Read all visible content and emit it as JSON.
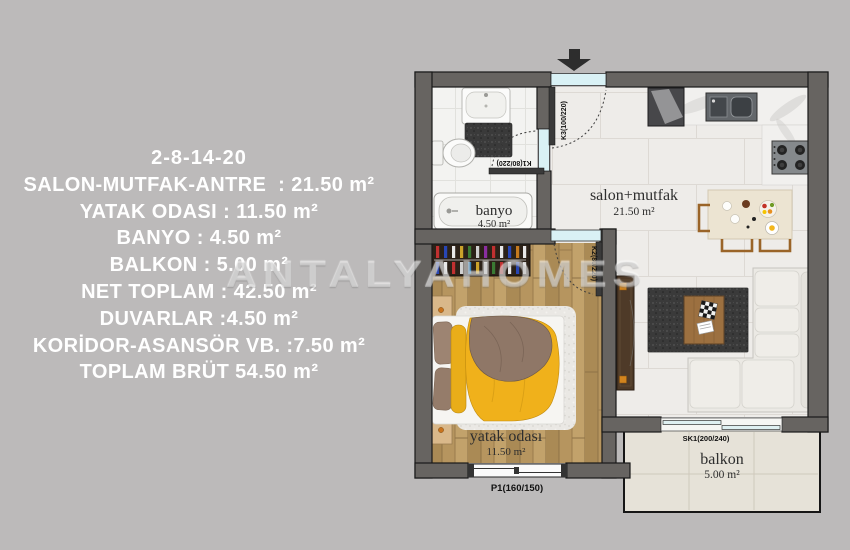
{
  "colors": {
    "background": "#bcbaba",
    "panel_text": "#ffffff",
    "wall": "#676461",
    "glass": "#d9f1f5",
    "duvet_yellow": "#f0b11b",
    "wood_floor": "#b3925e",
    "balcony_floor": "#e6e2d8"
  },
  "info_panel": {
    "unit_numbers": "2-8-14-20",
    "lines": [
      "SALON-MUTFAK-ANTRE  : 21.50 m²",
      "YATAK ODASI : 11.50 m²",
      "BANYO : 4.50 m²",
      "BALKON : 5.00 m²",
      "NET TOPLAM : 42.50 m²",
      "DUVARLAR :4.50 m²",
      "KORİDOR-ASANSÖR VB. :7.50 m²",
      "TOPLAM BRÜT 54.50 m²"
    ]
  },
  "watermark": {
    "brand_part1": "ANTALYA",
    "brand_part2": "HOMES"
  },
  "floor_plan": {
    "rooms": [
      {
        "name": "banyo",
        "area": "4.50 m²"
      },
      {
        "name": "salon+mutfak",
        "area": "21.50 m²"
      },
      {
        "name": "yatak odası",
        "area": "11.50 m²"
      },
      {
        "name": "balkon",
        "area": "5.00 m²"
      }
    ],
    "door_labels": {
      "entrance": "K3(100/220)",
      "bathroom": "K1(80/220)",
      "bedroom": "K2(80/220)",
      "balcony_slider": "SK1(200/240)",
      "bedroom_window": "P1(160/150)"
    }
  }
}
